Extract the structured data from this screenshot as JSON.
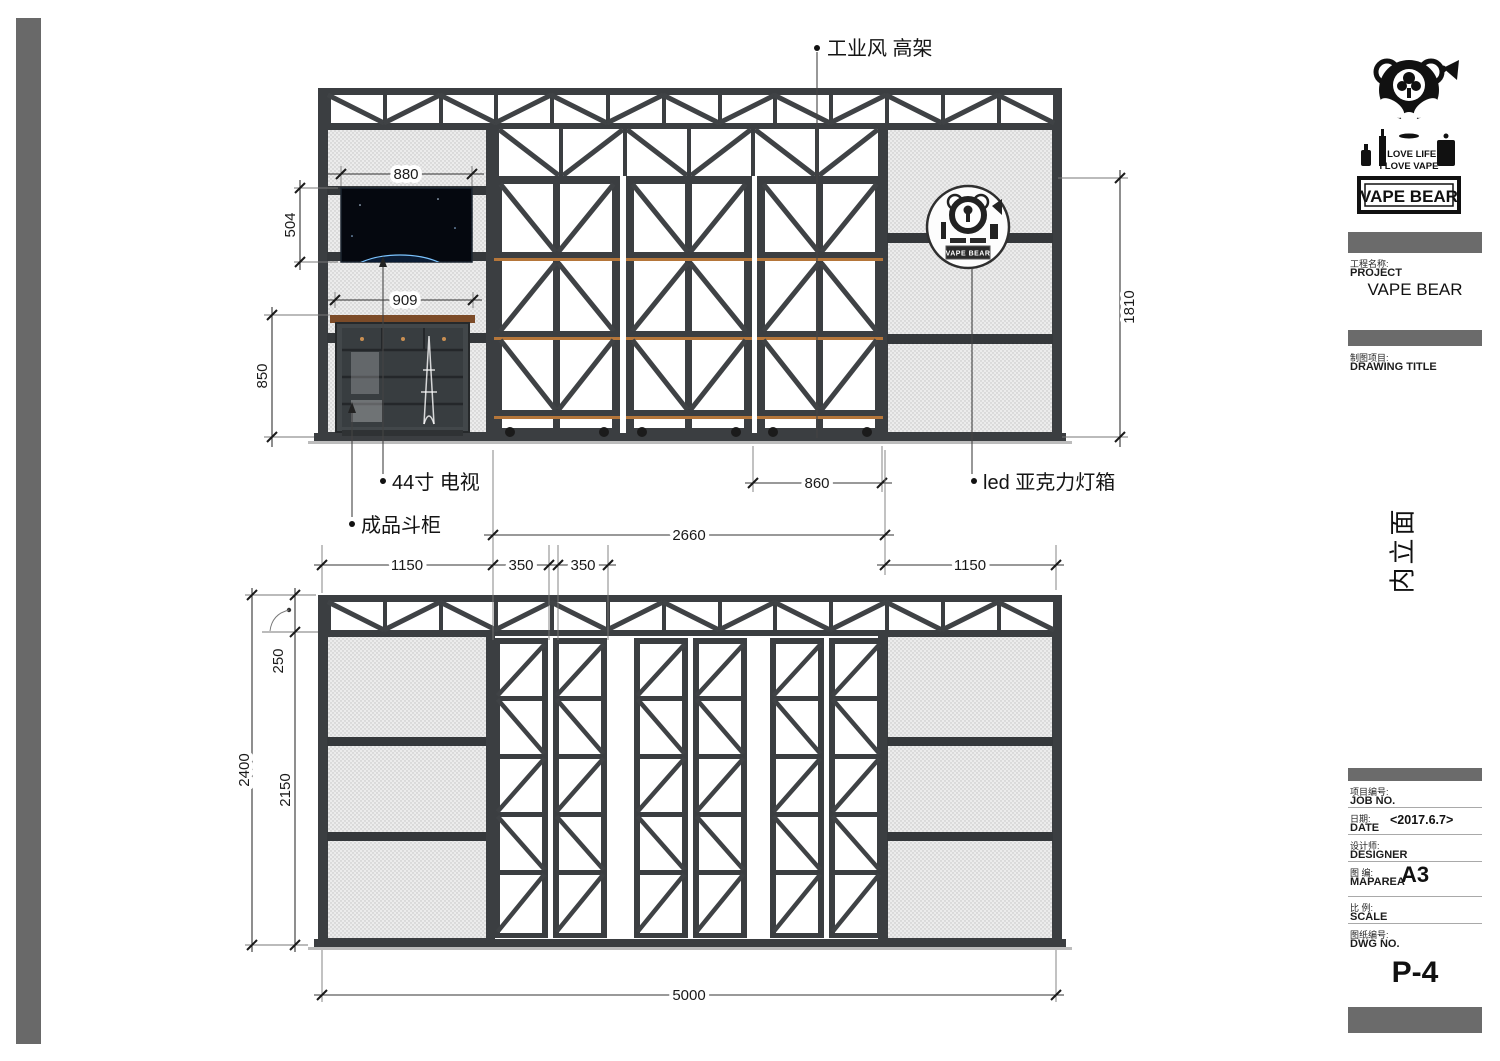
{
  "logo": {
    "line1": "I LOVE LIFE",
    "line2": "I LOVE VAPE",
    "brand": "VAPE BEAR"
  },
  "drawing": {
    "labels": {
      "shelf": "工业风 高架",
      "tv": "44寸 电视",
      "cabinet": "成品斗柜",
      "led": "led 亚克力灯箱",
      "badge": "VAPE BEAR"
    },
    "dims": {
      "tv_w": "880",
      "tv_h": "504",
      "cabinet_w": "909",
      "cabinet_h": "850",
      "lightbox_h": "1810",
      "rack_w": "860",
      "mid_w": "2660",
      "left_w": "1150",
      "col_a": "350",
      "col_b": "350",
      "right_w": "1150",
      "truss_h": "250",
      "total_h": "2400",
      "body_h": "2150",
      "total_w": "5000"
    }
  },
  "orientation": "内立面",
  "titleblock": {
    "project_zh": "工程名称:",
    "project_en": "PROJECT",
    "project_value": "VAPE BEAR",
    "drawing_title_zh": "制图项目:",
    "drawing_title_en": "DRAWING TITLE",
    "job_zh": "项目编号:",
    "job_en": "JOB NO.",
    "date_zh": "日期:",
    "date_en": "DATE",
    "date_value": "<2017.6.7>",
    "designer_zh": "设计师:",
    "designer_en": "DESIGNER",
    "maparea_zh": "图 编:",
    "maparea_en": "MAPAREA",
    "maparea_value": "A3",
    "scale_zh": "比 例:",
    "scale_en": "SCALE",
    "dwg_zh": "图纸编号:",
    "dwg_en": "DWG NO.",
    "sheet_no": "P-4"
  }
}
